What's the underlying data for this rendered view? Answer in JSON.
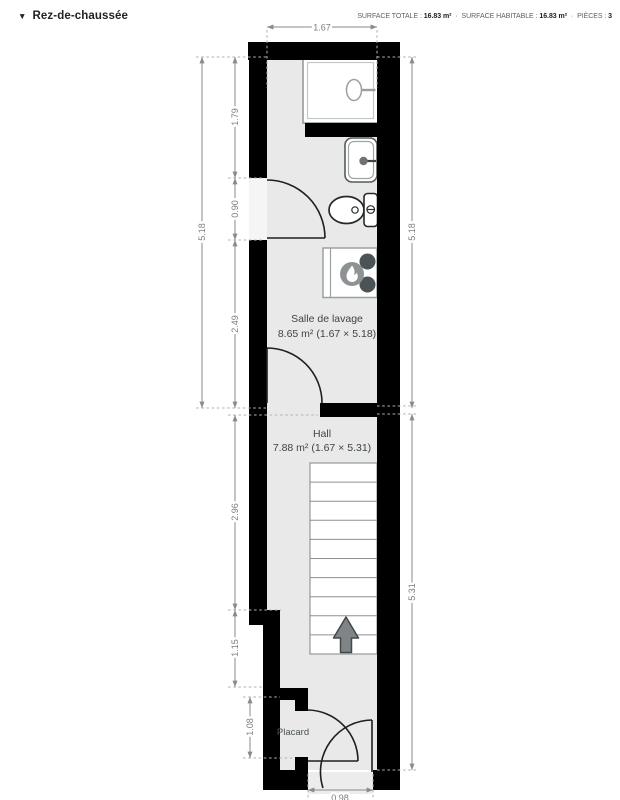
{
  "header": {
    "floor_label": "Rez-de-chaussée",
    "separator": "·",
    "stats": [
      {
        "label": "SURFACE TOTALE :",
        "value": "16.83 m²"
      },
      {
        "label": "SURFACE HABITABLE :",
        "value": "16.83 m²"
      },
      {
        "label": "PIÈCES :",
        "value": "3"
      }
    ]
  },
  "plan": {
    "rooms": {
      "laundry": {
        "name": "Salle de lavage",
        "area": "8.65 m² (1.67 × 5.18)"
      },
      "hall": {
        "name": "Hall",
        "area": "7.88 m² (1.67 × 5.31)"
      },
      "closet": {
        "name": "Placard"
      }
    },
    "dimensions": {
      "top_width": "1.67",
      "left_total": "5.18",
      "laundry_top": "1.79",
      "laundry_door": "0.90",
      "laundry_bottom": "2.49",
      "hall_upper": "2.96",
      "hall_lower": "1.15",
      "closet_height": "1.08",
      "right_laundry": "5.18",
      "right_hall": "5.31",
      "entrance_width": "0.98"
    },
    "colors": {
      "wall": "#000000",
      "floor": "#e9e9e9",
      "dimension": "#7d7d7d",
      "fixture_outline": "#9aa0a2",
      "stairs_arrow": "#7f8486",
      "appliance_knob": "#4c5356",
      "flame_badge": "#8d9394"
    }
  }
}
